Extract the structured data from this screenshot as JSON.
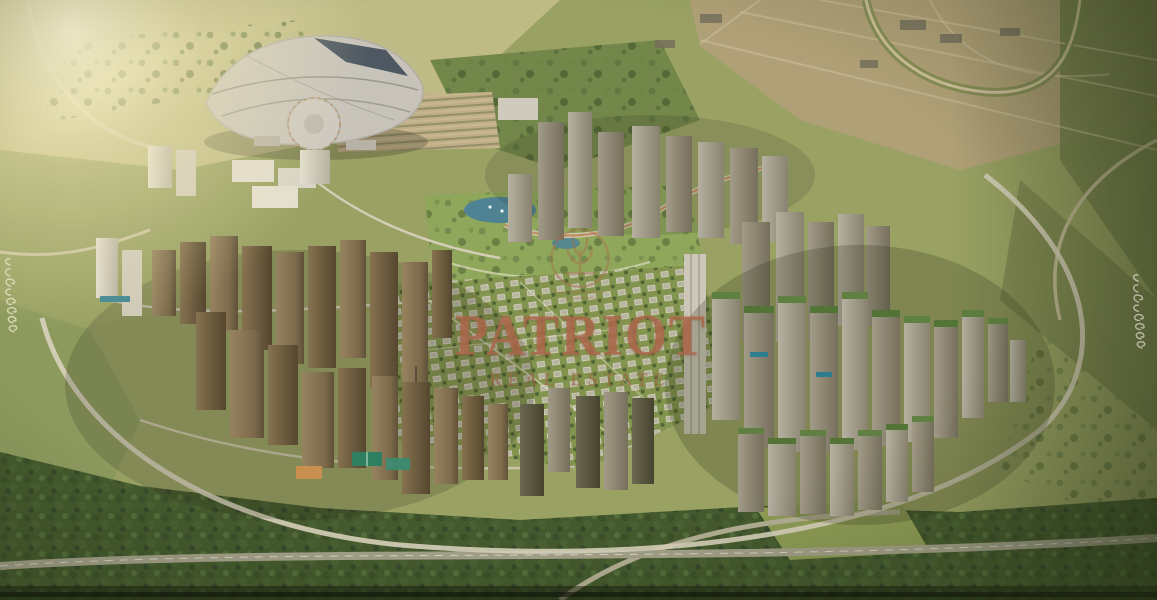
{
  "watermark": {
    "brand": "PATRIOT",
    "tagline": "REAL ESTATE",
    "text_color": "#ad684c",
    "emblem": "circular-tree-crest"
  },
  "edge_signatures": {
    "left": "cursive-script-signature",
    "right": "cursive-script-signature"
  },
  "scene": {
    "type": "aerial-masterplan-render",
    "regions": [
      "countryside",
      "desert-plain",
      "sun-glow",
      "exhibition-dome",
      "parking-lot",
      "tower-cluster-left",
      "tower-cluster-north",
      "tower-cluster-right",
      "villa-district",
      "central-park",
      "lake",
      "ring-road",
      "monorail-viaduct",
      "green-belt",
      "highway",
      "vignette"
    ]
  },
  "palette": {
    "terrain_olive": "#99a163",
    "terrain_light": "#c6c08c",
    "desert_tan": "#b0a077",
    "tree_dark": "#44592d",
    "tower_brown": "#8a7657",
    "tower_gray": "#a8a295",
    "roof_green": "#5f8040",
    "water": "#4f8292",
    "road": "#d8d2bb",
    "watermark_copper": "#ad684c"
  }
}
